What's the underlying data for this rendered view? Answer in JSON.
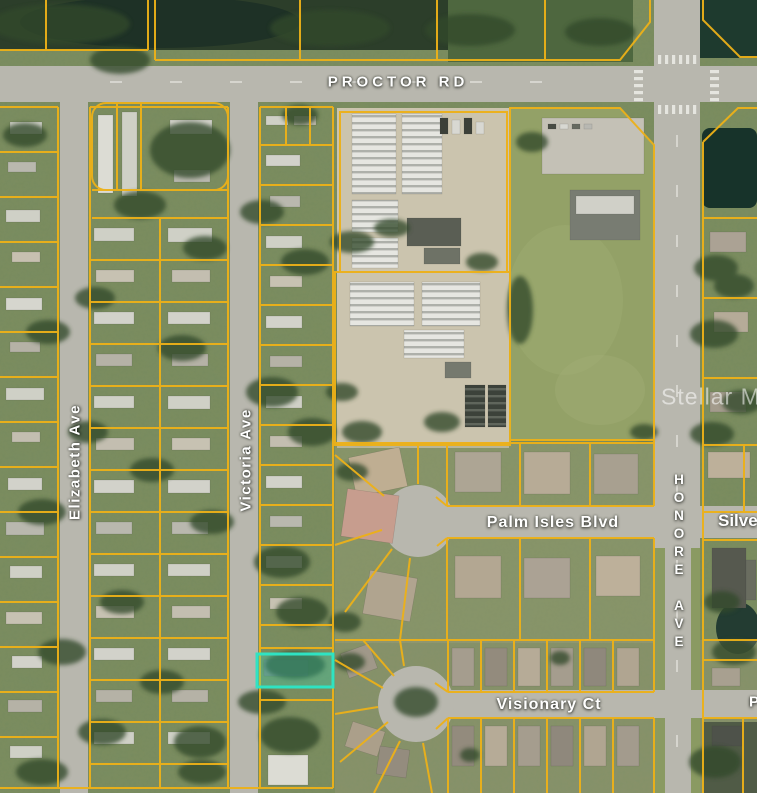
{
  "map": {
    "streets": {
      "proctor_rd": "PROCTOR RD",
      "elizabeth_ave": "Elizabeth Ave",
      "victoria_ave": "Victoria Ave",
      "palm_isles_blvd": "Palm Isles Blvd",
      "honore_ave": "HONORE AVE",
      "silver_partial": "Silve",
      "visionary_ct": "Visionary Ct",
      "right_edge_partial": "P"
    },
    "watermark": "Stellar MLS",
    "colors": {
      "parcel_line": "#edb118",
      "road": "#b8b7ae",
      "highlight_stroke": "#2fe3c2",
      "highlight_fill": "rgba(46,227,194,0.28)",
      "label_text": "#ffffff"
    }
  }
}
